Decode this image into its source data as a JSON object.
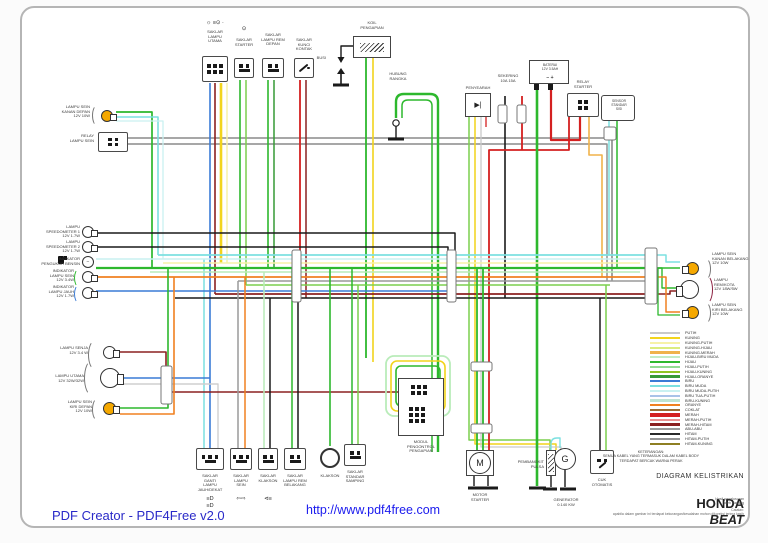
{
  "footer": {
    "creator": "PDF Creator - PDF4Free v2.0",
    "url": "http://www.pdf4free.com"
  },
  "title_block": {
    "keterangan": "KETERANGAN:\nSEMUA KABEL YANG TERMASUK DALAM KABEL BODY\nTERDAPAT BERCAK WARNA PERAK",
    "diagram_label": "DIAGRAM KELISTRIKAN",
    "model_make": "HONDA",
    "model_name": "BEAT",
    "credit": "Hasil penelusuran\noleh Yanang",
    "note": "Catatan:\napabila dalam gambar ini terdapat kekurangan/kesalahan mohon dikoreksi  terima kasih"
  },
  "components": {
    "saklar_lampu_utama": {
      "label": "SAKLAR\nLAMPU\nUTAMA",
      "icons": "☼ ≡⊙ ·"
    },
    "saklar_starter": {
      "label": "SAKLAR\nSTARTER",
      "icons": "⊙"
    },
    "saklar_lampu_rem_depan": {
      "label": "SAKLAR\nLAMPU REM\nDEPAN"
    },
    "saklar_kunci_kontak": {
      "label": "SAKLAR\nKUNCI\nKONTAK"
    },
    "busi": {
      "label": "BUSI"
    },
    "koil_pengapian": {
      "label": "KOIL\nPENGAPIAN"
    },
    "hubung_rangka": {
      "label": "HUBUNG\nRANGKA"
    },
    "penyearah": {
      "label": "PENYEARAH",
      "glyph": "▶|"
    },
    "sekering": {
      "label": "SEKERING\n10A  15A"
    },
    "baterai": {
      "label": "BATERAI\n12V 3.5AH",
      "terminals": "−       +"
    },
    "relay_starter": {
      "label": "RELAY\nSTARTER"
    },
    "sensor_standar_sisi": {
      "label": "SENSOR\nSTANDAR\nSISI"
    },
    "lampu_sein_kanan_depan": {
      "label": "LAMPU SEIN\nKANAN DEPAN\n12V 10W"
    },
    "relay_lampu_sein": {
      "label": "RELAY\nLAMPU SEIN"
    },
    "lampu_speedometer_1": {
      "label": "LAMPU\nSPEEDOMETER 1\n12V 1.7W"
    },
    "lampu_speedometer_2": {
      "label": "LAMPU\nSPEEDOMETER 2\n12V 1.7W"
    },
    "indikator_bensin": {
      "label": "INDIKATOR\nPENGUKUR BENSIN"
    },
    "indikator_lampu_sein": {
      "label": "INDIKATOR\nLAMPU SEIN\n12V 3.4W"
    },
    "indikator_lampu_jauh": {
      "label": "INDIKATOR\nLAMPU JAUH\n12V 1.7W"
    },
    "lampu_senja": {
      "label": "LAMPU SENJA\n12V 3.4 W"
    },
    "lampu_utama": {
      "label": "LAMPU UTAMA\n12V 32W/32W"
    },
    "lampu_sein_kiri_depan": {
      "label": "LAMPU SEIN\nKIRI DEPAN\n12V 10W"
    },
    "lampu_sein_kanan_belakang": {
      "label": "LAMPU SEIN\nKANAN BELAKANG\n12V 10W"
    },
    "lampu_rem_kota": {
      "label": "LAMPU\nREM/KOTA\n12V 18W/5W"
    },
    "lampu_sein_kiri_belakang": {
      "label": "LAMPU SEIN\nKIRI BELAKANG\n12V 10W"
    },
    "saklar_ganti_lampu": {
      "label": "SAKLAR\nGANTI\nLAMPU\nJAUH/DEKAT",
      "icons": "≡D\n≡D"
    },
    "saklar_lampu_sein": {
      "label": "SAKLAR\nLAMPU\nSEIN",
      "icons": "⇦⇨"
    },
    "saklar_klakson": {
      "label": "SAKLAR\nKLAKSON",
      "icons": "⊲≡"
    },
    "saklar_lampu_rem_belakang": {
      "label": "SAKLAR\nLAMPU REM\nBELAKANG"
    },
    "klakson": {
      "label": "KLAKSON"
    },
    "saklar_standar_samping": {
      "label": "SAKLAR\nSTANDAR\nSAMPING"
    },
    "modul_pengontrol": {
      "label": "MODUL\nPENGONTROL\nPENGAPIAN"
    },
    "motor_starter": {
      "label": "MOTOR\nSTARTER",
      "symbol": "M"
    },
    "pembangkit_pulsa": {
      "label": "PEMBANGKIT\nPULSA"
    },
    "generator": {
      "label": "GENERATOR\n0.140 KW",
      "symbol": "G"
    },
    "cuk_otomatis": {
      "label": "CUK\nOTOMATIS"
    }
  },
  "legend": {
    "items": [
      {
        "label": "PUTIH",
        "color": "#c9c9c9"
      },
      {
        "label": "KUNING",
        "color": "#f2d41c"
      },
      {
        "label": "KUNING-PUTIH",
        "color": "#f7f2a8"
      },
      {
        "label": "KUNING-HIJAU",
        "color": "#dcec7e"
      },
      {
        "label": "KUNING-MERAH",
        "color": "#f0b24a"
      },
      {
        "label": "HIJAU-BIRU MUDA",
        "color": "#c4ecc4"
      },
      {
        "label": "HIJAU",
        "color": "#2db82d"
      },
      {
        "label": "HIJAU-PUTIH",
        "color": "#93dc93"
      },
      {
        "label": "HIJAU-KUNING",
        "color": "#2db82d",
        "stripe": "#f2d41c"
      },
      {
        "label": "HIJAU-ORANYE",
        "color": "#379a37"
      },
      {
        "label": "BIRU",
        "color": "#3a7bd5"
      },
      {
        "label": "BIRU MUDA",
        "color": "#7ce0e0"
      },
      {
        "label": "BIRU MUDA-PUTIH",
        "color": "#c9f1f1"
      },
      {
        "label": "BIRU TUA-PUTIH",
        "color": "#a9c3e8"
      },
      {
        "label": "BIRU-KUNING",
        "color": "#bfe3d3"
      },
      {
        "label": "ORANYE",
        "color": "#f08020"
      },
      {
        "label": "COKLAT",
        "color": "#9a6a32"
      },
      {
        "label": "MERAH",
        "color": "#d42020",
        "thick": true
      },
      {
        "label": "MERAH-PUTIH",
        "color": "#d42020",
        "stripe": "#ffffff"
      },
      {
        "label": "MERAH-HITAM",
        "color": "#8b2020"
      },
      {
        "label": "ABU-ABU",
        "color": "#9a9a9a"
      },
      {
        "label": "HITAM",
        "color": "#2a2a2a"
      },
      {
        "label": "HITAM-PUTIH",
        "color": "#2a2a2a",
        "stripe": "#ffffff"
      },
      {
        "label": "HITAM-KUNING",
        "color": "#2a2a2a",
        "stripe": "#f2d41c"
      }
    ]
  }
}
